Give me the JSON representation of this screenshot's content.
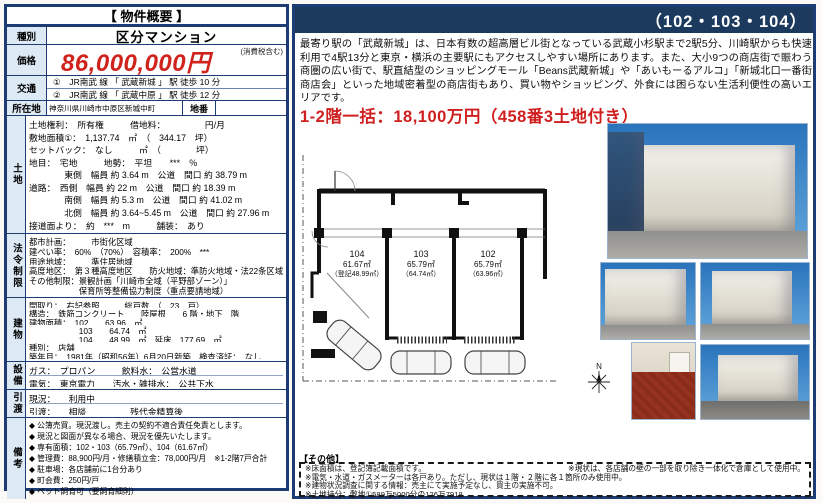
{
  "colors": {
    "navy": "#1e3c74",
    "header_navy": "#1c3a5e",
    "price_red": "#cf231c",
    "label_blue": "#dde9f5"
  },
  "overview": {
    "title": "【 物件概要 】",
    "kind_label": "種別",
    "kind_value": "区分マンション",
    "price_label": "価格",
    "price_value": "86,000,000円",
    "price_tax_note": "(消費税含む)",
    "access_label": "交通",
    "access_lines": [
      "①　JR南武 線 「 武蔵新城 」 駅 徒歩 10 分",
      "②　JR南武 線 「 武蔵中原 」 駅 徒歩 12 分"
    ],
    "location_label": "所在地",
    "location_value": "神奈川県川崎市中原区新城中町",
    "lot_number_label": "地番",
    "lot_number_value": "",
    "land": {
      "label": "土地",
      "lines": [
        "土地権利：　所有権　　　借地料：　　　　　円/月",
        "敷地面積①：　1,137.74　㎡　（　344.17　坪）",
        "セットバック：　なし　　　㎡　（　　　　坪）",
        "地目：　宅地　　　地勢：　平坦　　***　％",
        "　　　　東側　幅員 約 3.64 m　公道　間口 約 38.79 m",
        "道路：　西側　幅員 約 22 m　公道　間口 約 18.39 m",
        "　　　　南側　幅員 約 5.3 m　公道　間口 約 41.02 m",
        "　　　　北側　幅員 約 3.64~5.45 m　公道　間口 約 27.96 m",
        "接道面より：　約　***　m　　　舗装：　あり"
      ]
    },
    "legal": {
      "label": "法令制限",
      "lines": [
        "都市計画：　　　市街化区域",
        "建ぺい率：　60%　（70%）　容積率：　200%　***",
        "用途地域：　　　準住居地域",
        "高度地区：　第３種高度地区　　防火地域：準防火地域・法22条区域",
        "その他制限：景観計画「川崎市全域（平野部ゾーン）」",
        "　　　　　　保育所等整備協力制度（重点要請地域）"
      ]
    },
    "building": {
      "label": "建物",
      "lines": [
        "間取り：　右記参照　　　総戸数　（　23　戸）",
        "構造：　鉄筋コンクリート　　陸屋根　　6 階・地下　階",
        "建物面積：　102　　63.96　㎡",
        "　　　　　　103　　64.74　㎡",
        "　　　　　　104　　48.99　㎡　延床　177.69　㎡",
        "種別：　店舗",
        "築年月：　1981年（昭和56年）6月20日新築　検査済証：　なし"
      ]
    },
    "facilities": {
      "label": "設備",
      "lines": [
        "ガス：　プロパン　　　飲料水：　公営水道",
        "電気：　東京電力　　汚水・雑排水：　公共下水"
      ]
    },
    "handover": {
      "label": "引渡",
      "lines": [
        "現況：　　利用中",
        "引渡：　　相談　　　　　残代金精算後"
      ]
    },
    "remarks": {
      "label": "備考",
      "lines": [
        "◆ 公簿売買。現況渡し。売主の契約不適合責任免責とします。",
        "◆ 現況と図面が異なる場合、現況を優先いたします。",
        "◆ 専有面積：102・103（65.79㎡）、104（61.67㎡）",
        "◆ 管理費：88,900円/月・修繕積立金：78,000円/月　※1-2階7戸合計",
        "◆ 駐車場：各店舗前に1台分あり",
        "◆ 町会費：250円/戸",
        "◆ ペット飼育可（要飼育細則）"
      ]
    }
  },
  "right": {
    "header_title": "（102・103・104）",
    "description": "最寄り駅の「武蔵新城」は、日本有数の超高層ビル街となっている武蔵小杉駅まで2駅5分、川崎駅からも快速利用で4駅13分と東京・横浜の主要駅にもアクセスしやすい場所にあります。また、大小9つの商店街で賑わう商圏の広い街で、駅直結型のショッピングモール「Beans武蔵新城」や「あいもーるアルコ」「新城北口一番街商店会」といった地域密着型の商店街もあり、買い物やショッピング、外食には困らない生活利便性の高いエリアです。",
    "price_highlight": "1-2階一括：18,100万円（458番3土地付き）",
    "floorplan": {
      "compass_label": "N",
      "units": [
        {
          "id": "104",
          "area": "61.67㎡",
          "registered": "（登記48.99㎡）"
        },
        {
          "id": "103",
          "area": "65.79㎡",
          "registered": "（64.74㎡）"
        },
        {
          "id": "102",
          "area": "65.79㎡",
          "registered": "（63.96㎡）"
        }
      ]
    },
    "other": {
      "title": "【その他】",
      "note_right": "※現状は、各店舗の壁の一部を取り除き一体化で倉庫として使用中。",
      "notes": [
        "※床面積は、登記簿記載面積です。",
        "※電気・水道・ガスメーターは各戸あり。ただし、現状は１階・２階に各１箇所のみ使用中。",
        "※建物状況調査に関する情報：売主にて実施予定なし、買主の実施不可。",
        "※土地持分：敷地①589万5000分の126万7918"
      ]
    }
  }
}
